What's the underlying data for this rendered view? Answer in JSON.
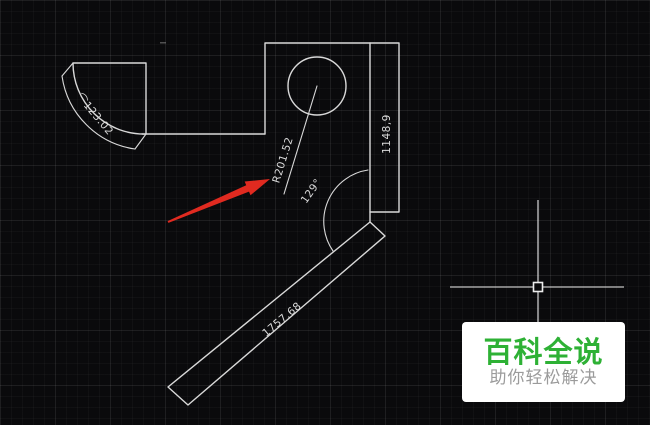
{
  "window": {
    "width_px": 650,
    "height_px": 425
  },
  "colors": {
    "background": "#0a0a0c",
    "grid_line_subtle": "#1c1c20",
    "drawing_line": "#d9d9d9",
    "dim_text": "#dcdcdc",
    "arrow_red": "#e02a20",
    "crosshair": "#ededed",
    "watermark_bg": "#ffffff",
    "watermark_title_green": "#2eb135",
    "watermark_subtitle_gray": "#9b9b9b"
  },
  "dimensions": {
    "arc_length": "⌒123.02",
    "radius": "R201.52",
    "angle": "129°",
    "height": "1148,9",
    "length": "1757.68"
  },
  "watermark": {
    "title": "百科全说",
    "subtitle": "助你轻松解决"
  }
}
